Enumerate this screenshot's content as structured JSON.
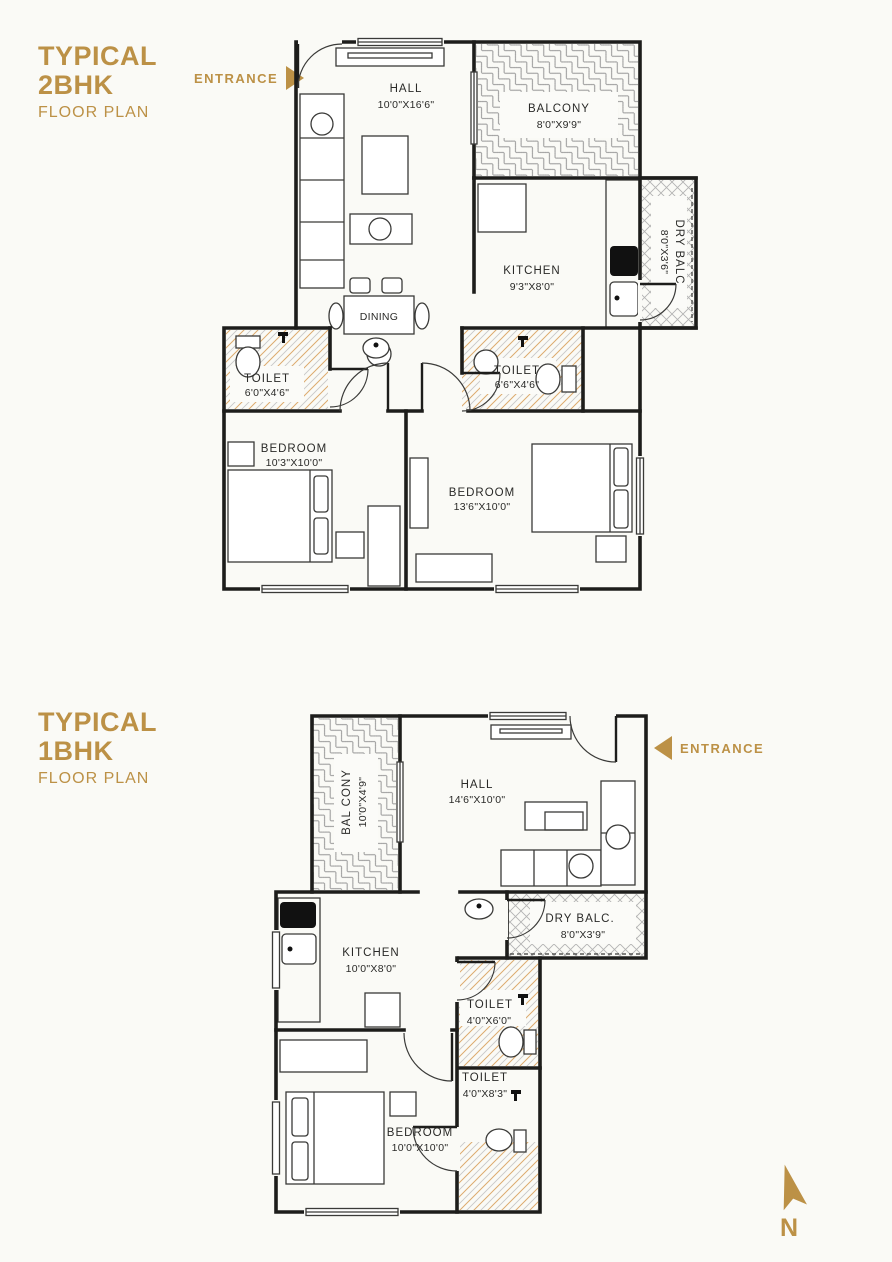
{
  "colors": {
    "accent": "#BC9146",
    "wall": "#1D1D1B",
    "paper": "#FAFAF6",
    "toilet_hatch": "#DDAB6E"
  },
  "compass": {
    "label": "N"
  },
  "plan_2bhk": {
    "title_line1": "TYPICAL",
    "title_line2": "2BHK",
    "subtitle": "FLOOR PLAN",
    "entrance": "ENTRANCE",
    "hall": {
      "name": "HALL",
      "dims": "10'0\"X16'6\""
    },
    "balcony": {
      "name": "BALCONY",
      "dims": "8'0\"X9'9\""
    },
    "kitchen": {
      "name": "KITCHEN",
      "dims": "9'3\"X8'0\""
    },
    "dry_balcony": {
      "name": "DRY BALC",
      "dims": "8'0\"X3'6\""
    },
    "dining": {
      "name": "DINING"
    },
    "toilet_left": {
      "name": "TOILET",
      "dims": "6'0\"X4'6\""
    },
    "toilet_right": {
      "name": "TOILET",
      "dims": "6'6\"X4'6\""
    },
    "bedroom_left": {
      "name": "BEDROOM",
      "dims": "10'3\"X10'0\""
    },
    "bedroom_right": {
      "name": "BEDROOM",
      "dims": "13'6\"X10'0\""
    }
  },
  "plan_1bhk": {
    "title_line1": "TYPICAL",
    "title_line2": "1BHK",
    "subtitle": "FLOOR PLAN",
    "entrance": "ENTRANCE",
    "hall": {
      "name": "HALL",
      "dims": "14'6\"X10'0\""
    },
    "balcony": {
      "name": "BAL CONY",
      "dims": "10'0\"X4'9\""
    },
    "dry_balcony": {
      "name": "DRY BALC.",
      "dims": "8'0\"X3'9\""
    },
    "kitchen": {
      "name": "KITCHEN",
      "dims": "10'0\"X8'0\""
    },
    "toilet_top": {
      "name": "TOILET",
      "dims": "4'0\"X6'0\""
    },
    "toilet_bottom": {
      "name": "TOILET",
      "dims": "4'0\"X8'3\""
    },
    "bedroom": {
      "name": "BEDROOM",
      "dims": "10'0\"X10'0\""
    }
  }
}
